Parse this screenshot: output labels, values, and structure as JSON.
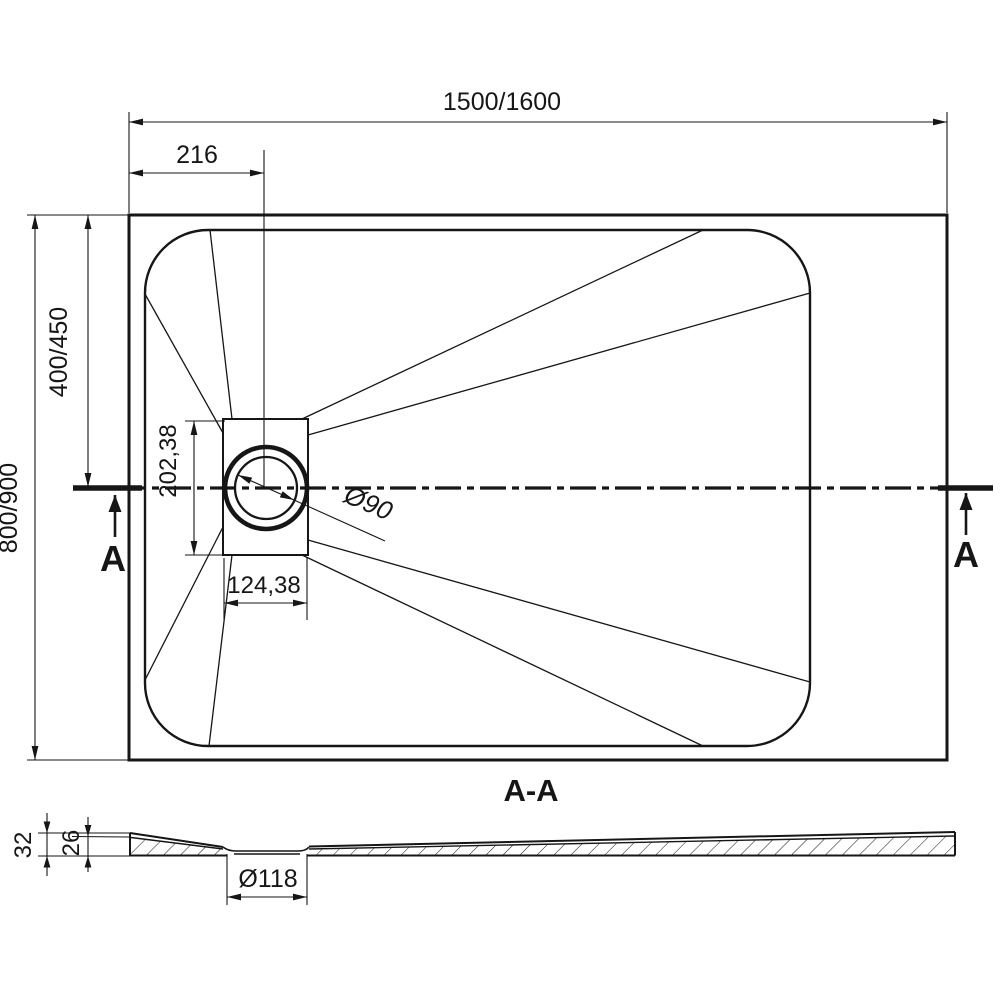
{
  "colors": {
    "ink": "#161616",
    "background": "#ffffff"
  },
  "plan": {
    "overall_width": "1500/1600",
    "drain_offset": "216",
    "drain_center_depth": "400/450",
    "overall_depth": "800/900",
    "recess_length": "202,38",
    "recess_width": "124,38",
    "drain_diameter": "Ø90",
    "cut_label_left": "A",
    "cut_label_right": "A"
  },
  "section": {
    "title": "A-A",
    "edge_height": "32",
    "inner_height": "26",
    "hole_diameter": "Ø118"
  }
}
